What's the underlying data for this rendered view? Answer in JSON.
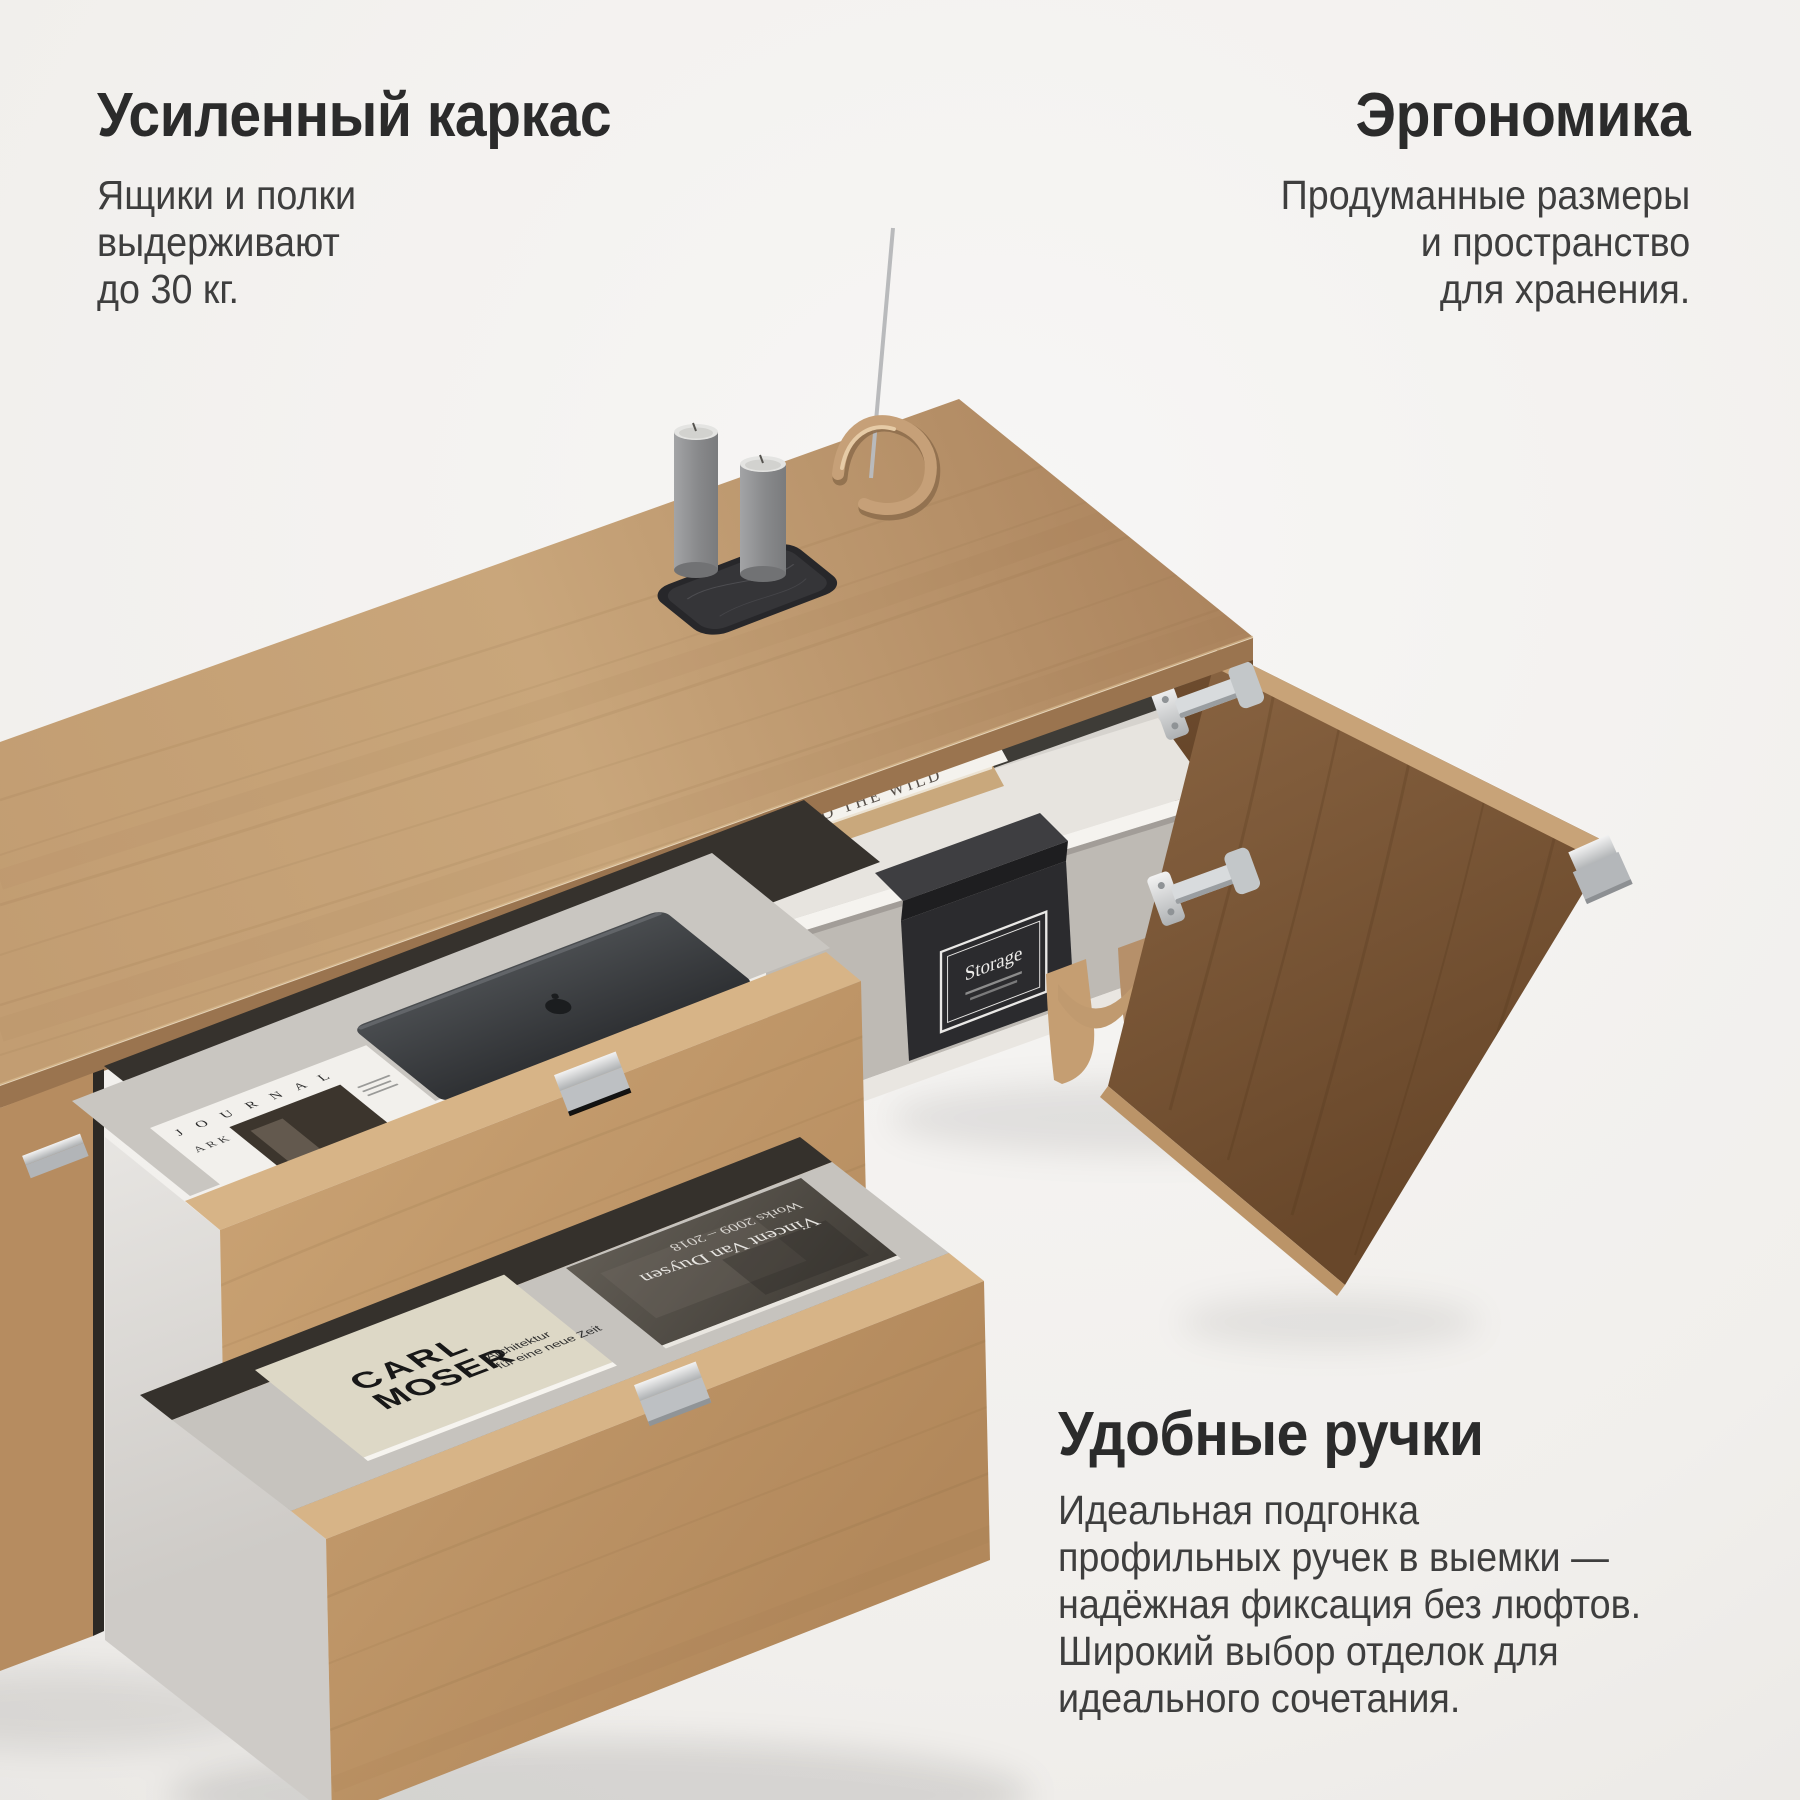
{
  "annotations": {
    "frame": {
      "title": "Усиленный каркас",
      "lines": [
        "Ящики и полки",
        "выдерживают",
        "до 30 кг."
      ]
    },
    "ergonomics": {
      "title": "Эргономика",
      "lines": [
        "Продуманные размеры",
        "и пространство",
        "для хранения."
      ]
    },
    "handles": {
      "title": "Удобные ручки",
      "lines": [
        "Идеальная подгонка",
        "профильных ручек в выемки —",
        "надёжная фиксация без люфтов.",
        "Широкий выбор отделок для",
        "идеального сочетания."
      ]
    }
  },
  "scene": {
    "books": {
      "wild_spine": "INTO THE WILD",
      "ark_label": "ARK",
      "ark_title": "J O U R N A L",
      "carl_line1": "CARL",
      "carl_line2": "MOSER",
      "carl_sub1": "Architektur",
      "carl_sub2": "für eine neue Zeit",
      "duysen_line1": "Vincent Van Duysen",
      "duysen_line2": "Works 2009 – 2018"
    },
    "box": {
      "label": "Storage"
    },
    "palette": {
      "background": "#f2f0ee",
      "oak_light": "#c9a67b",
      "oak_mid": "#b18a62",
      "oak_shadow": "#9a744f",
      "walnut_door": "#755232",
      "interior_white": "#eceae5",
      "interior_gray": "#c9c6c1",
      "metal_chrome": "#d4d7d9",
      "tray_black": "#28282a",
      "candle_gray": "#8f9092",
      "brass": "#c6a078",
      "heading_text": "#2b2b2b",
      "body_text": "#3e3e3e"
    }
  }
}
